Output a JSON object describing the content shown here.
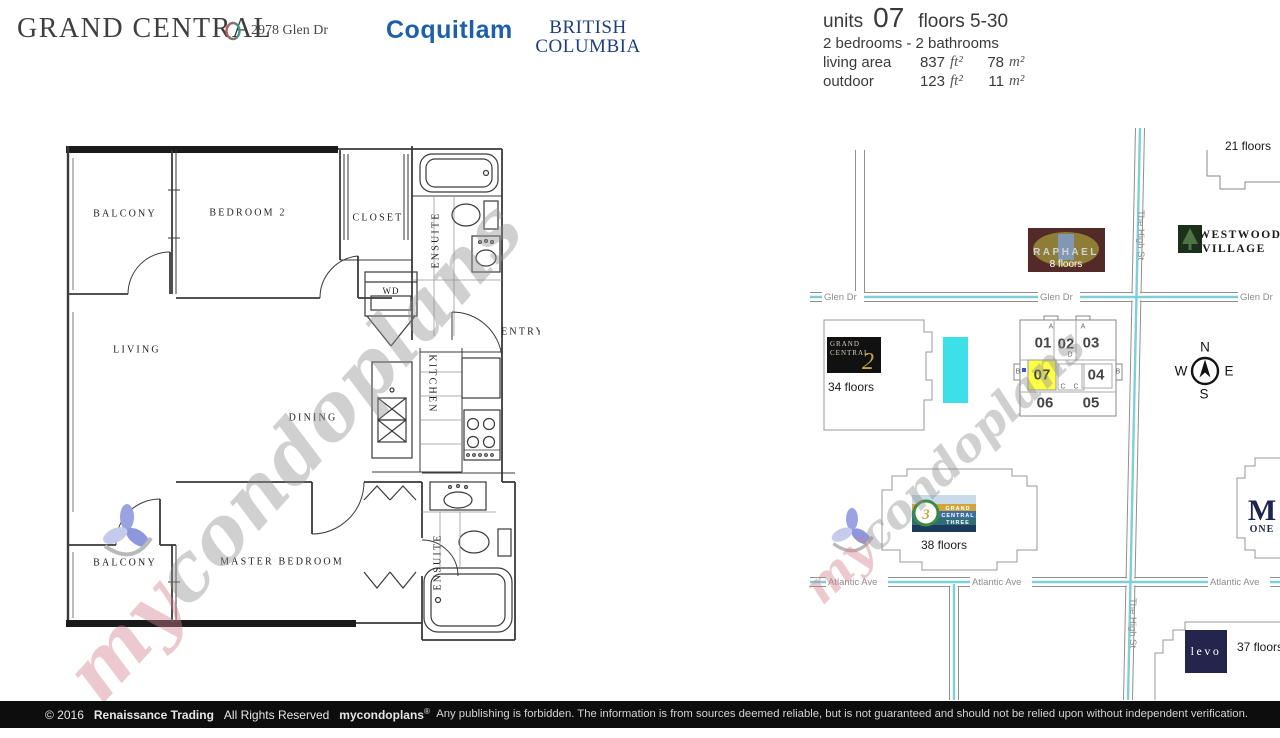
{
  "header": {
    "building_name": "GRAND CENTRAL",
    "address": "2978 Glen Dr",
    "city": "Coquitlam",
    "province_line1": "BRITISH",
    "province_line2": "COLUMBIA"
  },
  "unit_info": {
    "units_label": "units",
    "unit_number": "07",
    "floors_range": "floors 5-30",
    "bedrooms_bathrooms": "2 bedrooms - 2 bathrooms",
    "living_area": {
      "label": "living area",
      "sqft": "837",
      "sqft_unit": "ft²",
      "sqm": "78",
      "sqm_unit": "m²"
    },
    "outdoor": {
      "label": "outdoor",
      "sqft": "123",
      "sqft_unit": "ft²",
      "sqm": "11",
      "sqm_unit": "m²"
    }
  },
  "floor_plan": {
    "rooms": {
      "balcony_top": "BALCONY",
      "bedroom2": "BEDROOM 2",
      "closet": "CLOSET",
      "ensuite_top": "ENSUITE",
      "wd": "WD",
      "entry": "ENTRY",
      "living": "LIVING",
      "dining": "DINING",
      "kitchen": "KITCHEN",
      "master_bedroom": "MASTER BEDROOM",
      "balcony_bottom": "BALCONY",
      "ensuite_bottom": "ENSUITE"
    }
  },
  "map": {
    "streets": {
      "glen": "Glen Dr",
      "atlantic": "Atlantic Ave",
      "high": "The High St"
    },
    "buildings": {
      "tower21": {
        "floors": "21 floors"
      },
      "raphael": {
        "name": "RAPHAEL",
        "floors": "8 floors"
      },
      "westwood": {
        "line1": "WESTWOOD",
        "line2": "VILLAGE"
      },
      "grand_central_2": {
        "line1": "GRAND",
        "line2": "CENTRAL",
        "number": "2",
        "floors": "34 floors"
      },
      "grand_central_3": {
        "line1": "GRAND",
        "line2": "CENTRAL",
        "line3": "THREE",
        "number": "3",
        "floors": "38 floors"
      },
      "m_one": {
        "m": "M",
        "one": "ONE"
      },
      "levo": {
        "name": "levo",
        "floors": "37 floors"
      }
    },
    "keyplate": {
      "highlighted_unit": "07",
      "units": {
        "u01": "01",
        "u02": "02",
        "u03": "03",
        "u04": "04",
        "u05": "05",
        "u06": "06",
        "u07": "07"
      },
      "letters": {
        "a1": "A",
        "a2": "A",
        "b1": "B",
        "b2": "B",
        "c1": "C",
        "c2": "C",
        "d": "D"
      }
    },
    "compass": {
      "n": "N",
      "e": "E",
      "s": "S",
      "w": "W"
    }
  },
  "watermark": {
    "prefix": "my",
    "suffix": "condoplans"
  },
  "footer": {
    "copyright": "© 2016",
    "company": "Renaissance Trading",
    "rights": "All Rights Reserved",
    "brand": "mycondoplans",
    "registered": "®",
    "disclaimer": "Any publishing is forbidden.  The information is from sources deemed reliable, but is not guaranteed and should not be relied upon without independent verification."
  },
  "colors": {
    "highlight_yellow": "#ffff45",
    "street_blue": "#7ecfda",
    "pool_cyan": "#3ddfe8",
    "city_blue": "#1d60a8",
    "province_blue": "#1d3f7e"
  }
}
